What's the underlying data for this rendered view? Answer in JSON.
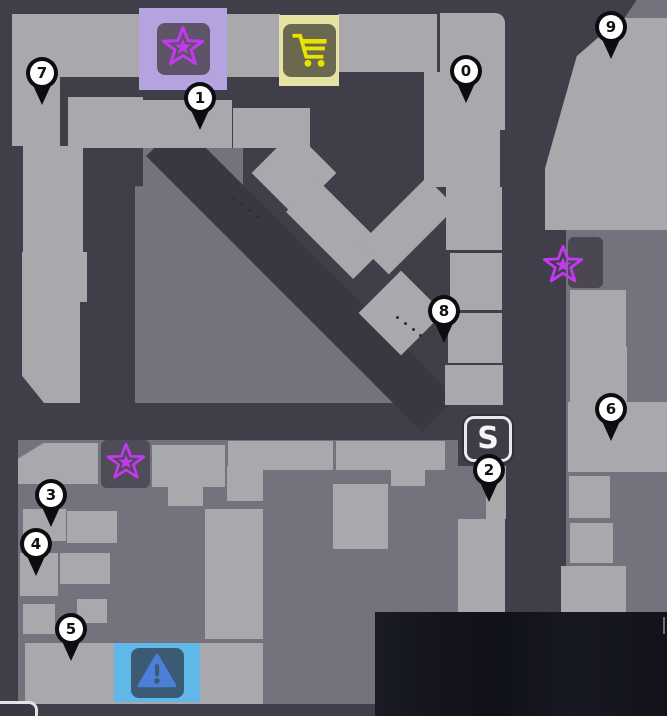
{
  "scene": "game-city-map-overview",
  "colors": {
    "street": "#3f3e49",
    "street_shadow": "#393842",
    "plaza": "#74727c",
    "building": "#a9a8ac",
    "pin_body": "#0c0c11",
    "pin_face": "#ffffff",
    "pin_text": "#111111"
  },
  "pins": [
    {
      "label": "7",
      "x": 42,
      "y": 73
    },
    {
      "label": "1",
      "x": 200,
      "y": 98
    },
    {
      "label": "0",
      "x": 466,
      "y": 71
    },
    {
      "label": "9",
      "x": 611,
      "y": 27
    },
    {
      "label": "8",
      "x": 444,
      "y": 311
    },
    {
      "label": "6",
      "x": 611,
      "y": 409
    },
    {
      "label": "2",
      "x": 489,
      "y": 470
    },
    {
      "label": "3",
      "x": 51,
      "y": 495
    },
    {
      "label": "4",
      "x": 36,
      "y": 544
    },
    {
      "label": "5",
      "x": 71,
      "y": 629
    }
  ],
  "badges": {
    "station": {
      "label": "S"
    }
  },
  "markers": {
    "purple_star_shop": {
      "glyph": "star",
      "box_color": "#b4a3df",
      "panel_color": "#5d5468",
      "glyph_color": "#c438f0"
    },
    "cart_shop": {
      "glyph": "shopping-cart",
      "box_color": "#e6e2a3",
      "panel_color": "#6a684e",
      "glyph_color": "#e8e400"
    },
    "warning_shop": {
      "glyph": "warning-triangle",
      "box_color": "#5fb8e8",
      "panel_color": "#3b5a74",
      "glyph_color": "#4c7fd7"
    },
    "star_southwest": {
      "glyph": "star",
      "panel_color": "#4f4b59",
      "glyph_color": "#c438f0"
    },
    "star_northeast": {
      "glyph": "star",
      "panel_color": "#4a4753",
      "glyph_color": "#c438f0"
    }
  }
}
